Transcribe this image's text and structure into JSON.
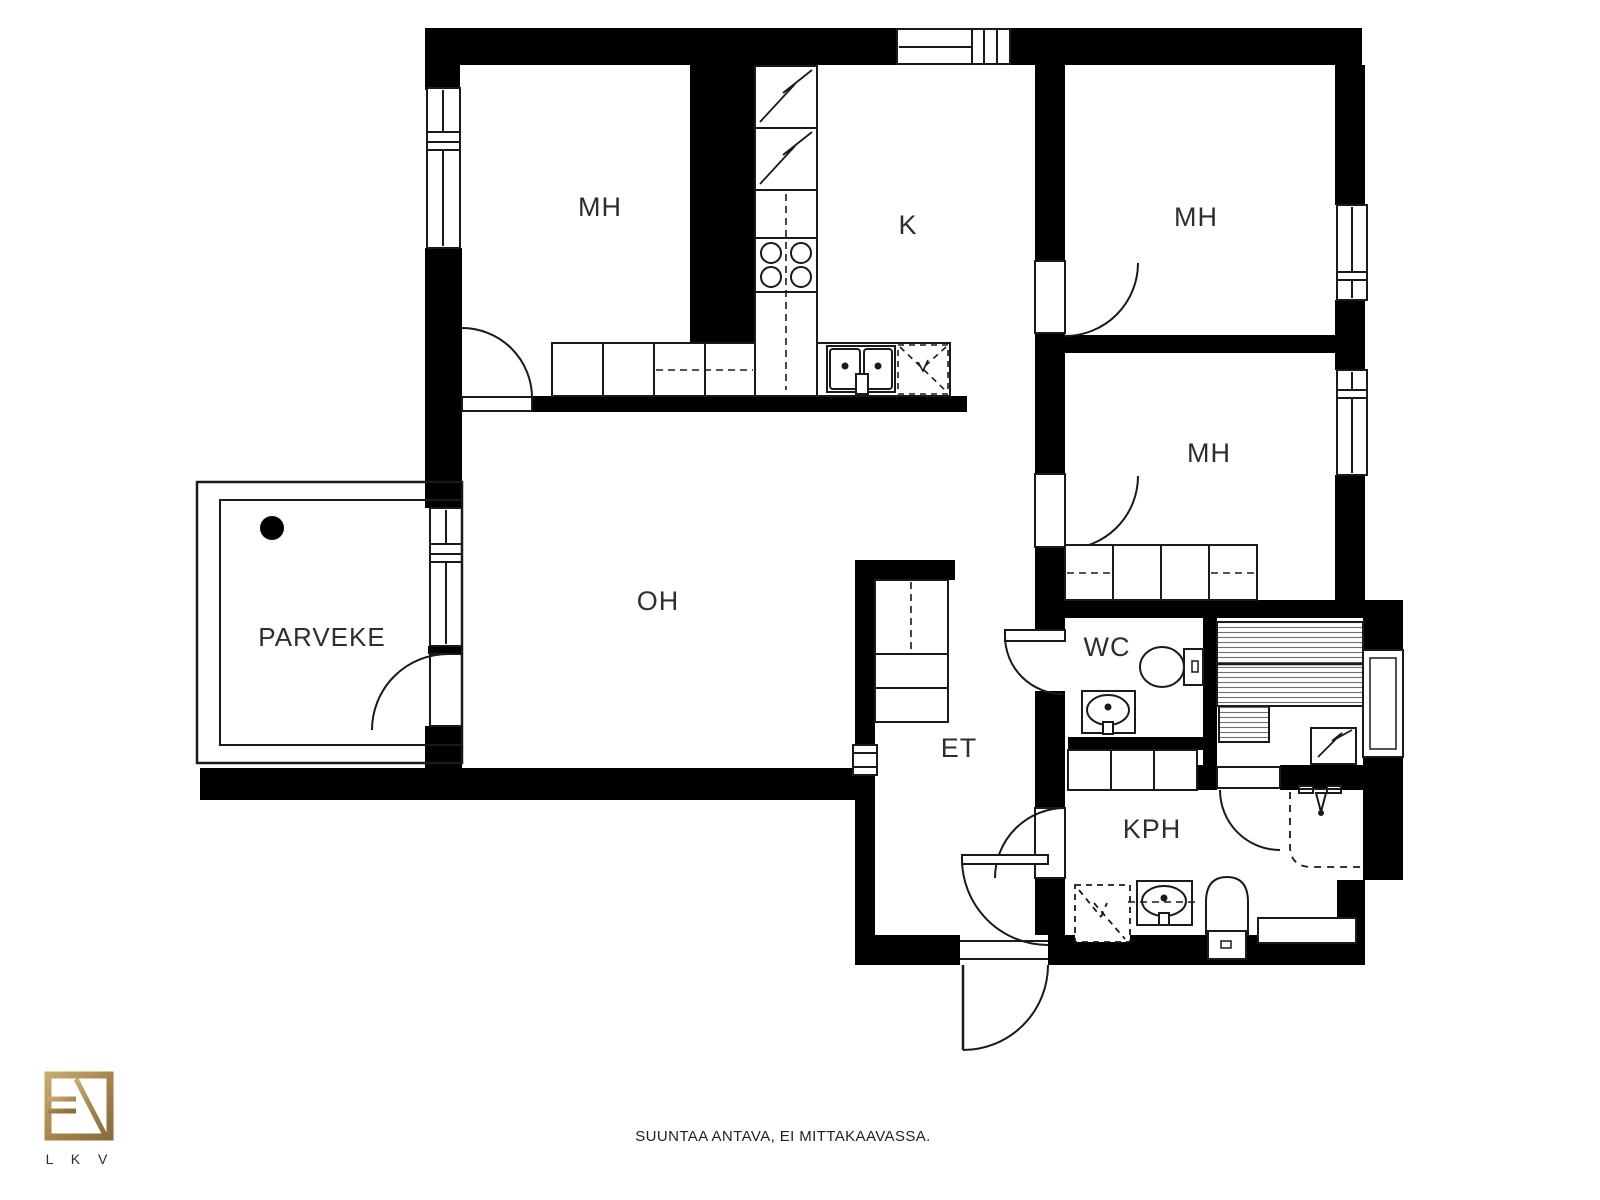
{
  "plan": {
    "rooms": {
      "mh_top_left": "MH",
      "kitchen": "K",
      "mh_top_right": "MH",
      "mh_mid_right": "MH",
      "living_room": "OH",
      "balcony": "PARVEKE",
      "wc": "WC",
      "hall": "ET",
      "bathroom": "KPH"
    }
  },
  "footer": {
    "disclaimer": "SUUNTAA ANTAVA, EI MITTAKAAVASSA."
  },
  "logo": {
    "caption": "L K V"
  },
  "colors": {
    "wall": "#000000",
    "line": "#1a1a1a",
    "logo_gold": "#a88a52",
    "label_text": "#2e2e2e"
  }
}
